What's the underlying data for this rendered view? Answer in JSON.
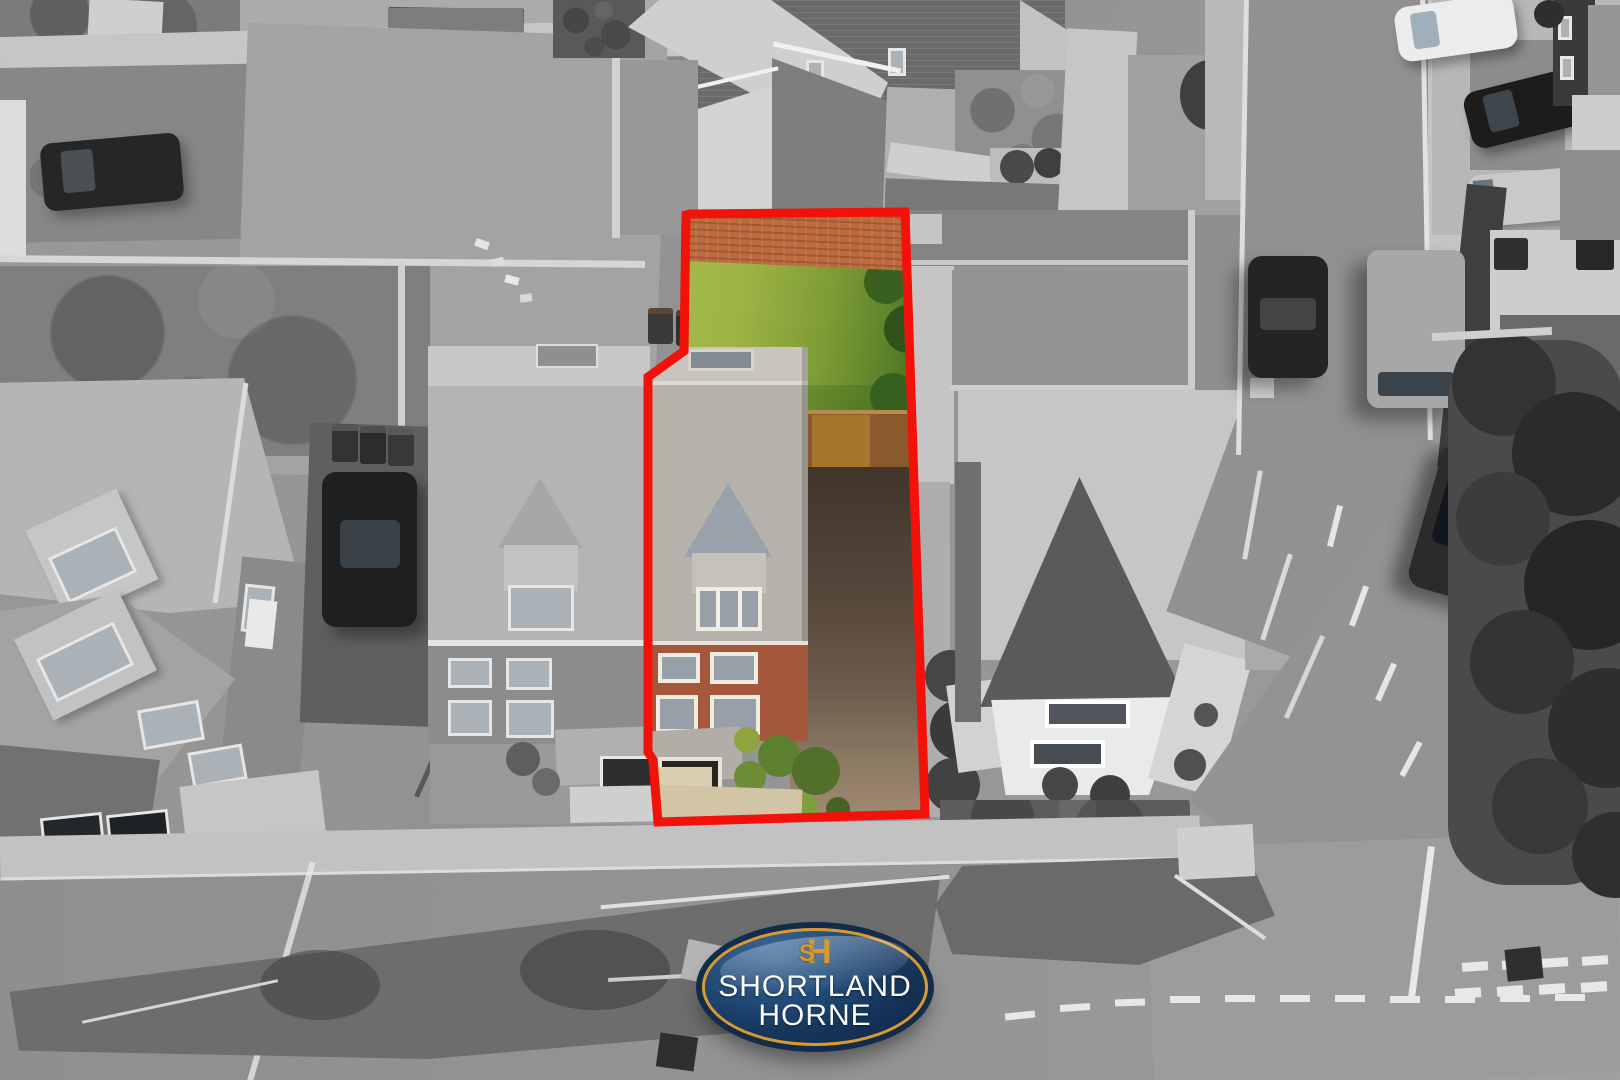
{
  "image": {
    "kind": "aerial property photograph",
    "width_px": 1620,
    "height_px": 1080,
    "description": "Black-and-white drone view of a housing estate; one plot is shown in colour and outlined in red; estate-agent logo badge at bottom centre"
  },
  "branding": {
    "monogram_s": "S",
    "monogram_h": "H",
    "line1": "SHORTLAND",
    "line2": "HORNE"
  },
  "palette": {
    "red-outline": "#f2120a",
    "logo-navy": "#16365c",
    "logo-navy-deep": "#0d2440",
    "logo-navy-light": "#3e6896",
    "logo-gold": "#d9992f",
    "logo-text": "#f8fafc",
    "lawn-bright": "#aabd4d",
    "lawn-mid": "#7d9c35",
    "lawn-dark": "#3f681f",
    "brick-wall": "#bd6b3e",
    "brick-facade": "#a4573a",
    "roof-plot": "#b6b1aa",
    "dormer-slate": "#99a1ab",
    "drive-dark": "#41362c",
    "drive-light": "#a18d72",
    "path-beige": "#d2c5a6",
    "fence-wood": "#8a5a2c",
    "shrub-dark": "#52702a",
    "shrub-light": "#8fa43c"
  }
}
